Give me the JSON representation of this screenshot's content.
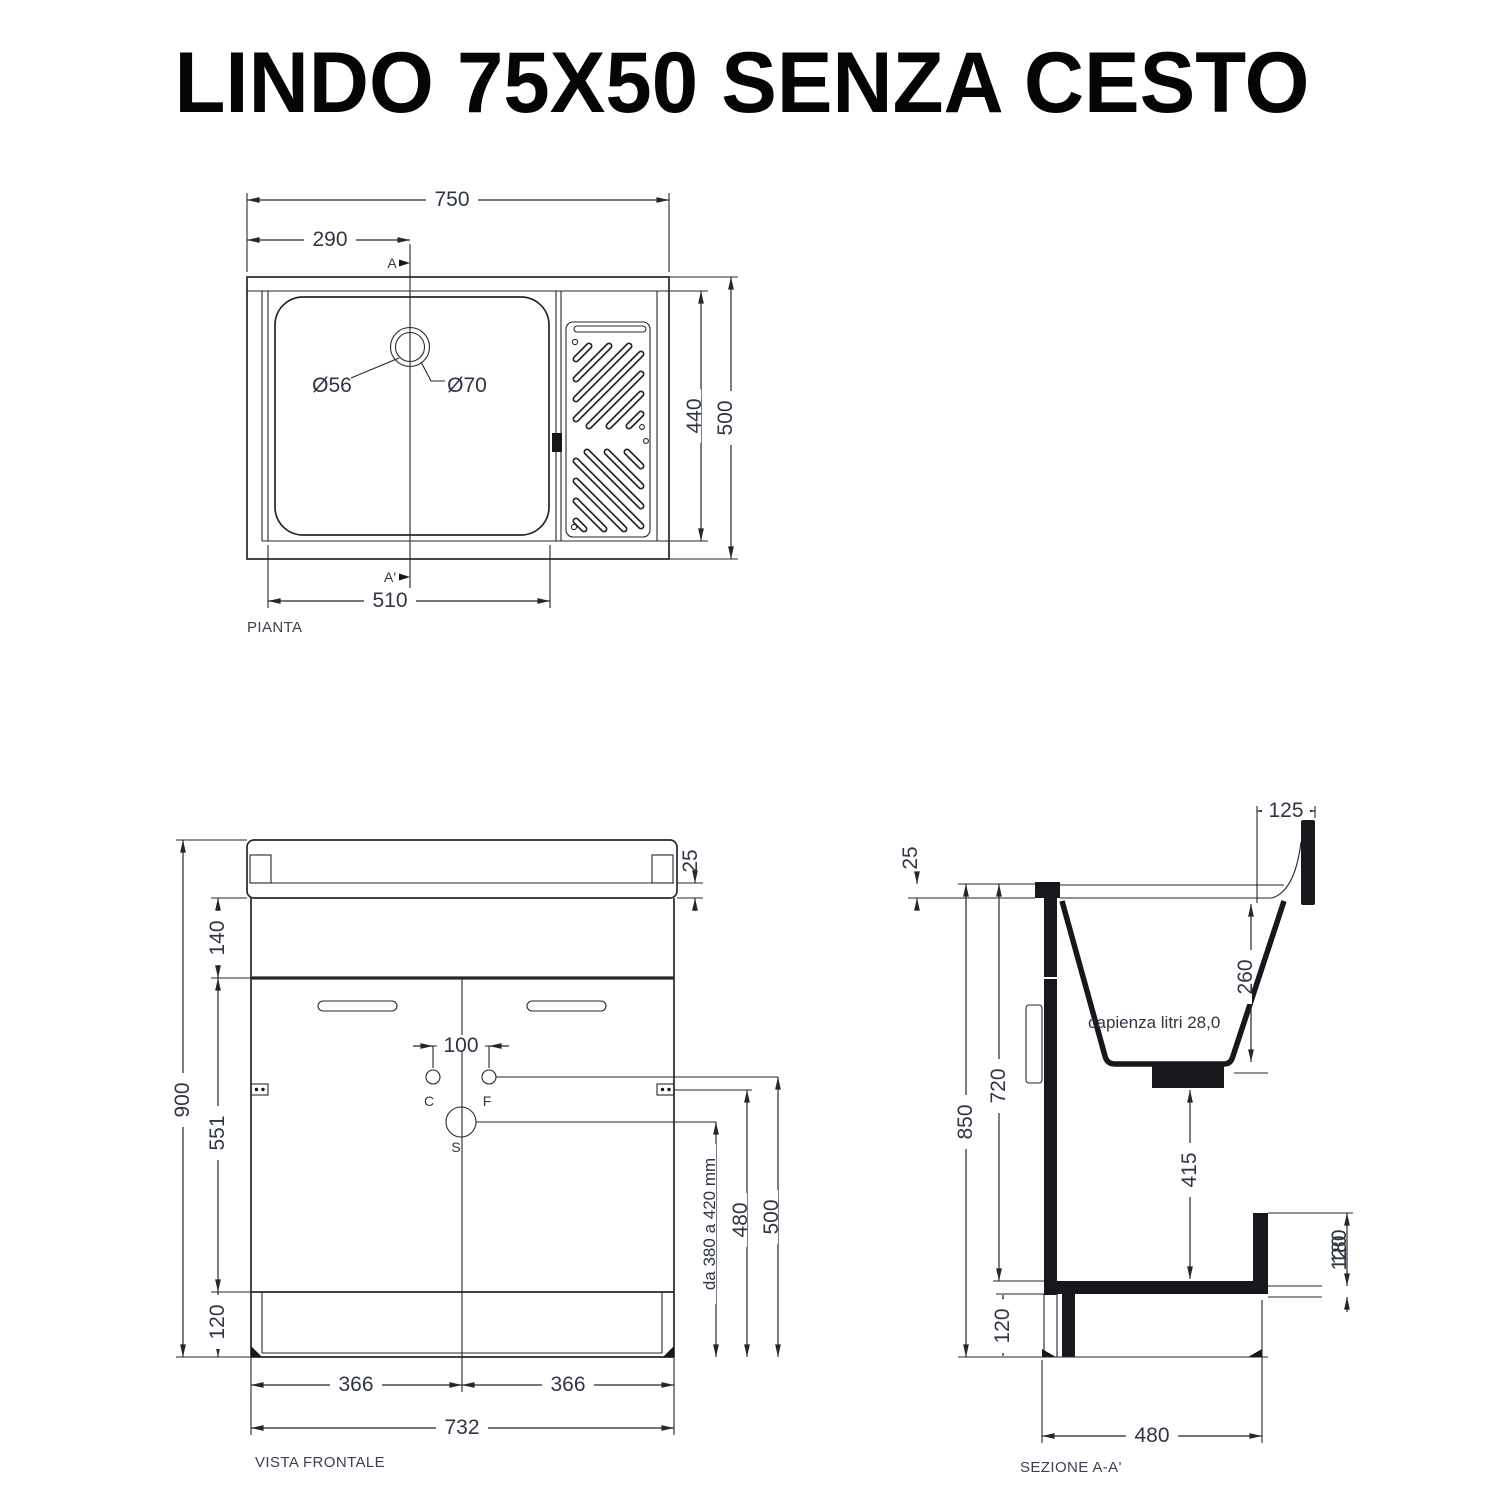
{
  "title": "LINDO 75X50 SENZA CESTO",
  "pianta": {
    "label": "PIANTA",
    "dim_width": "750",
    "dim_basin_x": "290",
    "dim_basin_w": "510",
    "dim_inner_depth": "440",
    "dim_depth": "500",
    "drain_inner": "Ø56",
    "drain_outer": "Ø70",
    "marker_a": "A",
    "marker_a1": "A'"
  },
  "frontale": {
    "label": "VISTA FRONTALE",
    "dim_height": "900",
    "dim_top_band": "140",
    "dim_door_h": "551",
    "dim_plinth": "120",
    "dim_lip": "25",
    "dim_tap_spacing": "100",
    "dim_door_left": "366",
    "dim_door_right": "366",
    "dim_width": "732",
    "dim_drain_range": "da 380 a 420 mm",
    "dim_cold_h": "480",
    "dim_hot_h": "500",
    "m_cold": "C",
    "m_hot": "F",
    "m_drain": "S"
  },
  "sezione": {
    "label": "SEZIONE A-A'",
    "capacity": "capienza litri 28,0",
    "dim_height": "850",
    "dim_inner_h": "720",
    "dim_lip": "25",
    "dim_rear_ledge": "125",
    "dim_tub_depth": "260",
    "dim_drain_bottom": "415",
    "dim_step_a": "180",
    "dim_step_b": "120",
    "dim_plinth": "120",
    "dim_depth": "480"
  }
}
